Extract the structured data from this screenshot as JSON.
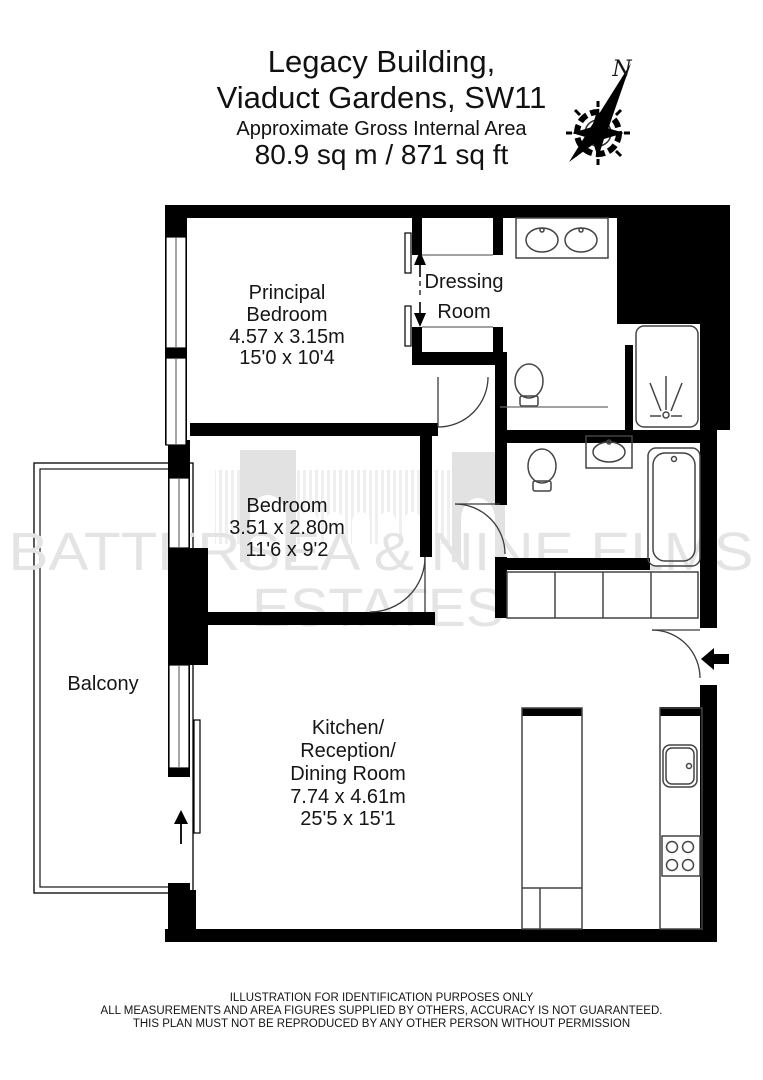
{
  "header": {
    "title_line1": "Legacy Building,",
    "title_line2": "Viaduct Gardens, SW11",
    "subtitle": "Approximate Gross Internal Area",
    "area": "80.9 sq m / 871 sq ft"
  },
  "compass": {
    "label": "N"
  },
  "watermark": {
    "line1": "BATTERSEA & NINE ELMS",
    "line2": "ESTATES"
  },
  "rooms": {
    "principal_bedroom": {
      "line1": "Principal",
      "line2": "Bedroom",
      "metric": "4.57 x 3.15m",
      "imperial": "15'0 x 10'4"
    },
    "dressing_room": {
      "line1": "Dressing",
      "line2": "Room"
    },
    "bedroom": {
      "line1": "Bedroom",
      "metric": "3.51 x 2.80m",
      "imperial": "11'6 x 9'2"
    },
    "kitchen": {
      "line1": "Kitchen/",
      "line2": "Reception/",
      "line3": "Dining Room",
      "metric": "7.74 x 4.61m",
      "imperial": "25'5 x 15'1"
    },
    "balcony": {
      "line1": "Balcony"
    }
  },
  "footer": {
    "line1": "ILLUSTRATION FOR IDENTIFICATION PURPOSES ONLY",
    "line2": "ALL MEASUREMENTS AND AREA FIGURES SUPPLIED BY OTHERS, ACCURACY IS NOT GUARANTEED.",
    "line3": "THIS PLAN MUST NOT BE REPRODUCED BY ANY OTHER PERSON WITHOUT PERMISSION"
  },
  "colors": {
    "wall": "#000000",
    "fixture_stroke": "#444444",
    "watermark": "#e4e4e4"
  }
}
